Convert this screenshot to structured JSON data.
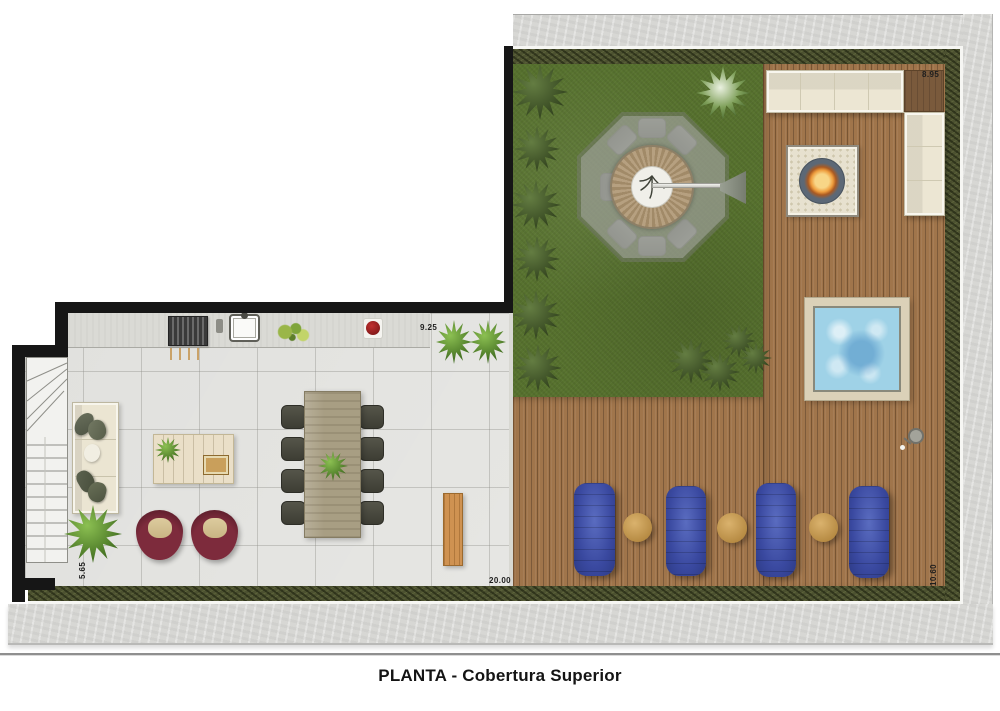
{
  "title": "PLANTA - Cobertura Superior",
  "dimensions": {
    "terrace_top": "8.95",
    "kitchen_wall": "9.25",
    "living_wall": "5.65",
    "bottom_total": "20.00",
    "terrace_right": "10.60"
  },
  "palette": {
    "grass": "#57722e",
    "deck_wood": "#a0754b",
    "hedge": "#4c5130",
    "concrete": "#d7d7d4",
    "wall": "#161616",
    "tile_floor": "#e6e6e3",
    "pool_water": "#9fd2e7",
    "lounger_blue": "#3a49a0",
    "armchair_maroon": "#6b2433",
    "sofa_cream": "#ece6d3",
    "fire": "#ee9c3d",
    "bench_wood": "#cf9251"
  }
}
